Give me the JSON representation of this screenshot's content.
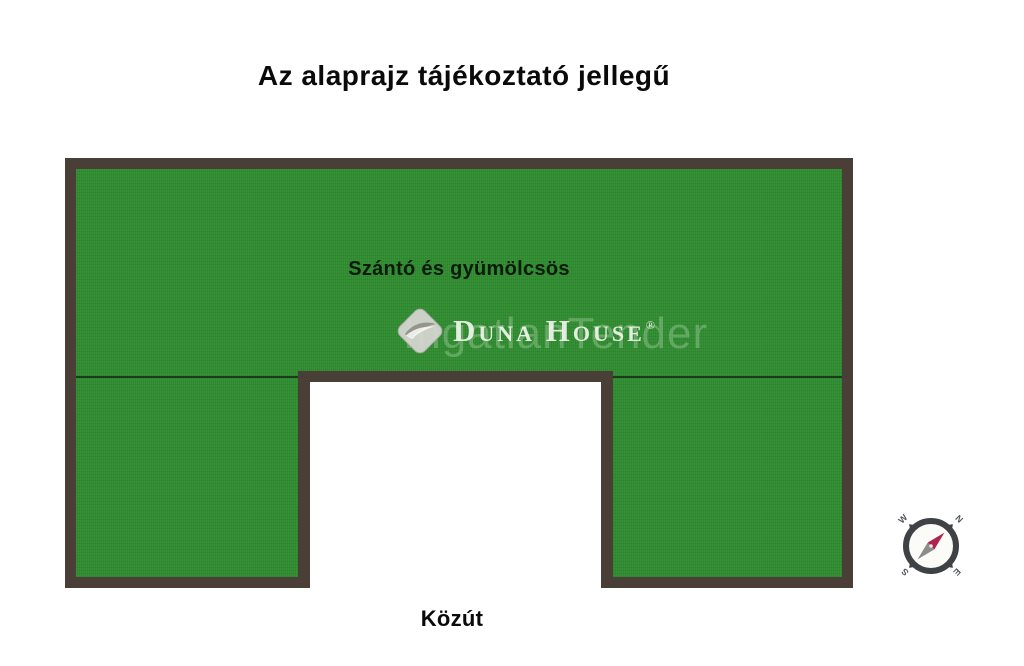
{
  "title": "Az alaprajz tájékoztató jellegű",
  "parcel": {
    "area_label": "Szántó és gyümölcsös",
    "road_label": "Közút"
  },
  "watermark": {
    "brand": "Duna House",
    "registered_mark": "®",
    "background_text": "IngatlanTender"
  },
  "compass": {
    "north": "N",
    "east": "E",
    "south": "S",
    "west": "W"
  },
  "colors": {
    "parcel_green": "#2e8b2e",
    "border_brown": "#4a3f36",
    "divider_line": "#1b3a1b",
    "notch_white": "#ffffff",
    "title_black": "#0a0a0a",
    "compass_ring": "#3f4245",
    "needle_red": "#b0234c",
    "needle_gray": "#8e8e88",
    "logo_gray": "#d7d6d2",
    "logo_swoosh": "#95958e",
    "logo_text": "#f6f6f1",
    "watermark_green": "#deeede"
  }
}
